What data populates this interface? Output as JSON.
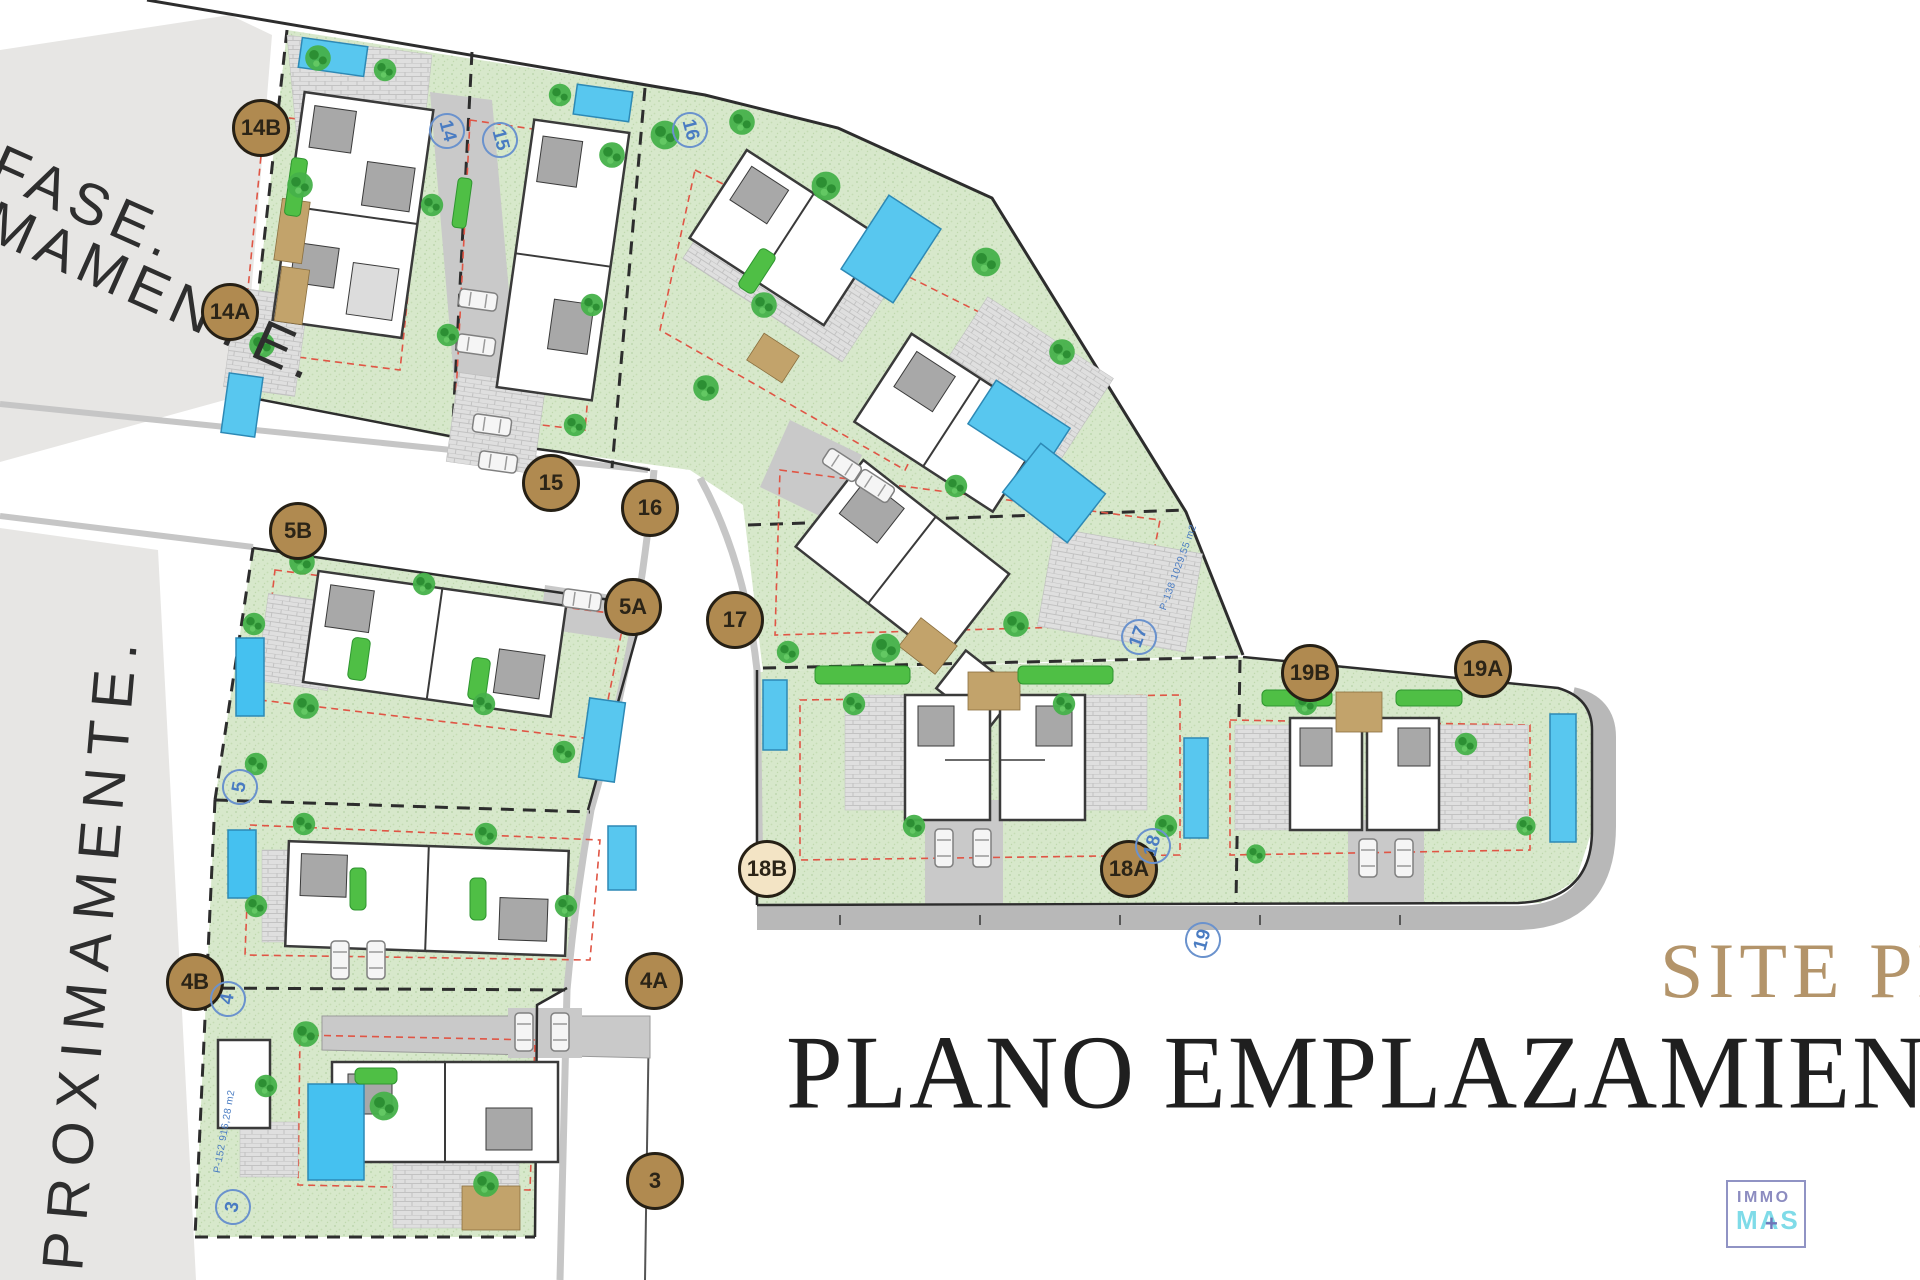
{
  "phase": {
    "line1": "FASE.",
    "line2": "MAMENTE.",
    "vertical": "PROXIMAMENTE."
  },
  "titles": {
    "site_plan_en": "SITE PLAN",
    "site_plan_es": "PLANO EMPLAZAMIENTO"
  },
  "logo": {
    "top": "IMMO",
    "bottom": "MAS",
    "plus": "+"
  },
  "badges": [
    {
      "label": "14B"
    },
    {
      "label": "14A"
    },
    {
      "label": "15"
    },
    {
      "label": "16"
    },
    {
      "label": "5B"
    },
    {
      "label": "5A"
    },
    {
      "label": "17"
    },
    {
      "label": "4B"
    },
    {
      "label": "4A"
    },
    {
      "label": "18B"
    },
    {
      "label": "18A"
    },
    {
      "label": "19B"
    },
    {
      "label": "19A"
    },
    {
      "label": "3"
    }
  ],
  "plot_numbers": [
    {
      "n": "14"
    },
    {
      "n": "15"
    },
    {
      "n": "16"
    },
    {
      "n": "5"
    },
    {
      "n": "4"
    },
    {
      "n": "3"
    },
    {
      "n": "17"
    },
    {
      "n": "18"
    },
    {
      "n": "19"
    }
  ],
  "plot_areas": {
    "p17": "P-138 1029,55 m2",
    "p3": "P-152 916,28 m2"
  },
  "colors": {
    "badge_fill": "#b08a50",
    "badge_light": "#f3e4c5",
    "title_gold": "#b3946a",
    "title_dark": "#1f1f1f",
    "label_blue": "#4a7cc2",
    "lawn_green": "#d7e8cb",
    "hedge_green": "#4fbf45",
    "pool_blue": "#58c7ef",
    "phase_gray": "#e7e6e4",
    "road_gray": "#cbcbcb",
    "logo_purple": "#8c8cc0",
    "logo_cyan": "#7fdbe8"
  }
}
